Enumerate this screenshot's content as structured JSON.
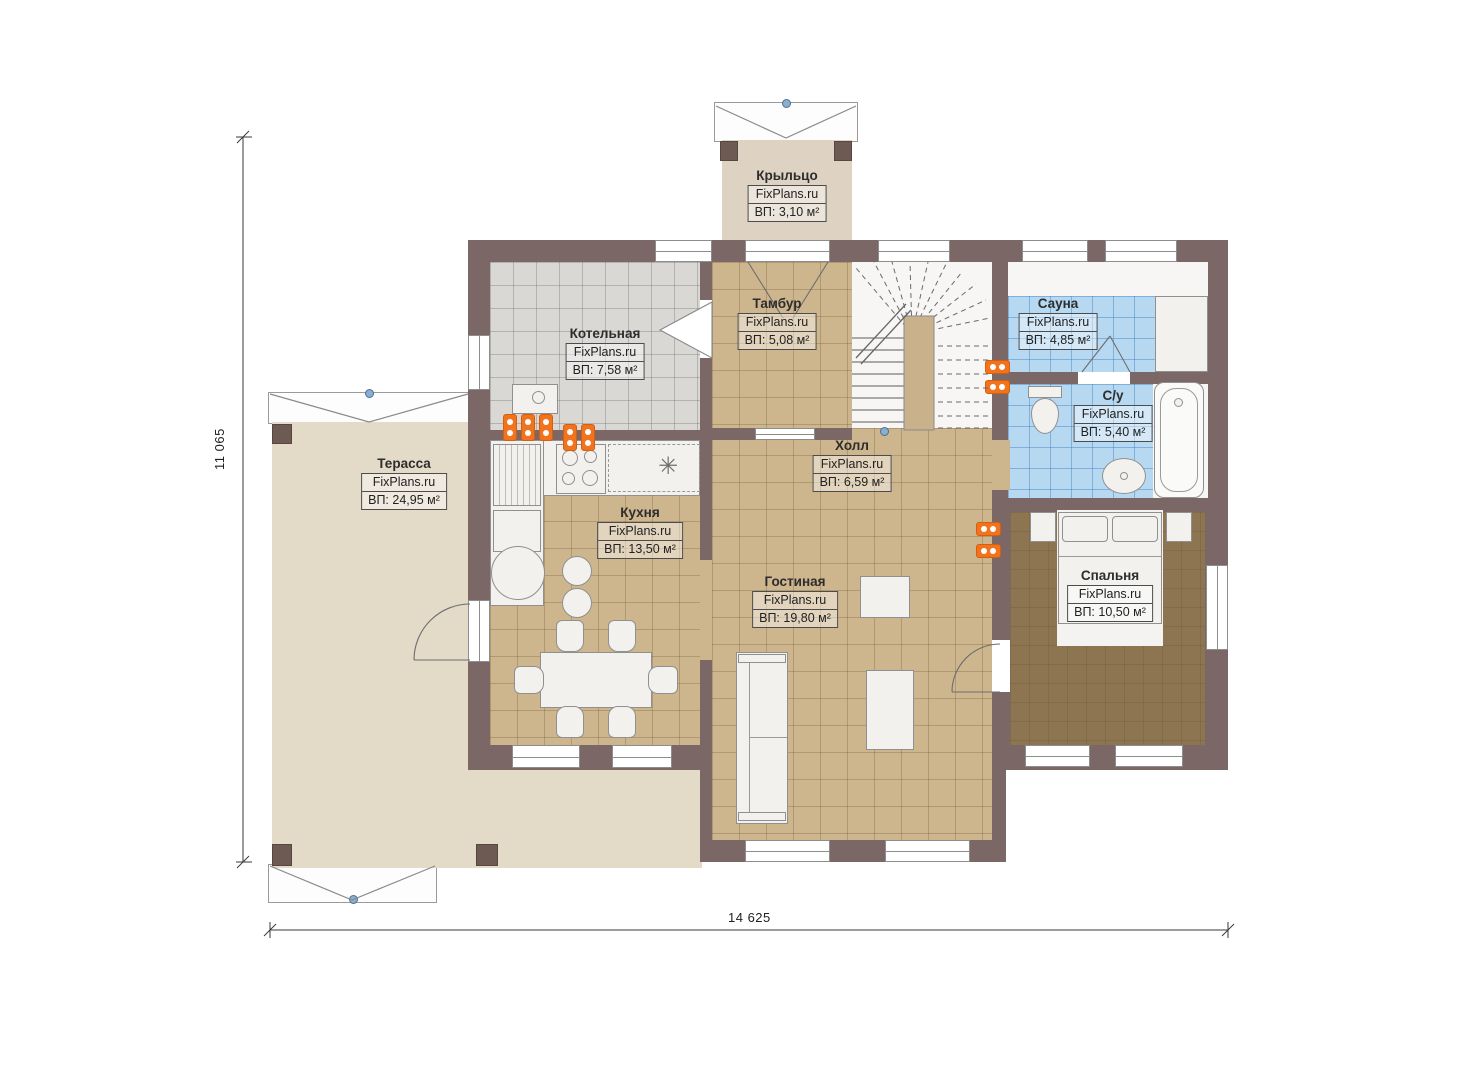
{
  "brand": "FixPlans.ru",
  "rooms": {
    "porch": {
      "name": "Крыльцо",
      "area": "ВП: 3,10 м²"
    },
    "boiler": {
      "name": "Котельная",
      "area": "ВП: 7,58 м²"
    },
    "tambour": {
      "name": "Тамбур",
      "area": "ВП: 5,08 м²"
    },
    "sauna": {
      "name": "Сауна",
      "area": "ВП: 4,85 м²"
    },
    "bathroom": {
      "name": "С/у",
      "area": "ВП: 5,40 м²"
    },
    "terrace": {
      "name": "Терасса",
      "area": "ВП: 24,95 м²"
    },
    "hall": {
      "name": "Холл",
      "area": "ВП: 6,59 м²"
    },
    "kitchen": {
      "name": "Кухня",
      "area": "ВП: 13,50 м²"
    },
    "living": {
      "name": "Гостиная",
      "area": "ВП: 19,80 м²"
    },
    "bedroom": {
      "name": "Спальня",
      "area": "ВП: 10,50 м²"
    }
  },
  "dimensions": {
    "width": "14 625",
    "height": "11 065"
  },
  "icons": {
    "freezer_snowflake": "✳"
  },
  "colors": {
    "wall": "#7c6767",
    "floor_beige": "#cdb58d",
    "floor_grey": "#d9d8d5",
    "tile_blue": "#b7d8f1",
    "carpet": "#8c7550",
    "deck": "#e3dac8",
    "radiator_orange": "#f2731d"
  }
}
